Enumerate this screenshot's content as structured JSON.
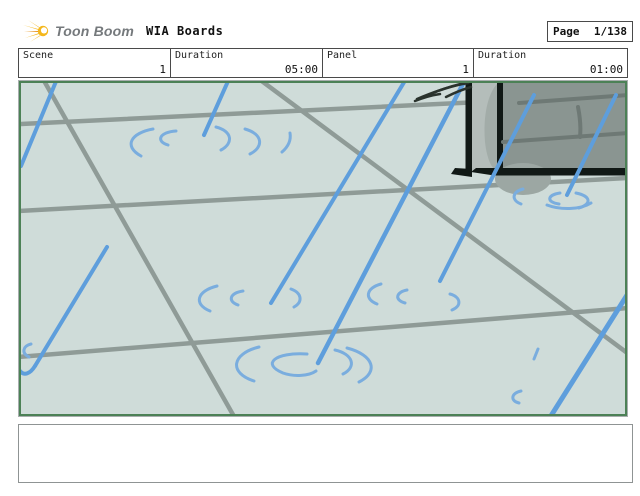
{
  "colors": {
    "page_bg": "#ffffff",
    "chrome_border": "#4a4a4a",
    "logo_yellow": "#f4b71c",
    "logo_orange": "#e89118",
    "logo_text_gray": "#75797c",
    "title_black": "#111111",
    "panel_frame_gray": "#a8aeae",
    "border_green": "#4c8156",
    "drawing_bg": "#cfdcd9",
    "tile_line": "#8f9b97",
    "rain_blue": "#5e9edc",
    "ripple_blue": "#7aadde",
    "box_front": "#8a9591",
    "box_side": "#b4bdba",
    "box_side_shade": "#a2aca8",
    "box_stripe": "#6e7975",
    "outline_black": "#111916",
    "shadow_gray": "#9ca7a3",
    "scribble_dark": "#2a332d",
    "caption_border": "#8f9494"
  },
  "header": {
    "logo_text": "Toon Boom",
    "title": "WIA Boards",
    "page_label": "Page",
    "page_number": "1/138"
  },
  "info_table": {
    "cells": [
      {
        "label": "Scene",
        "value": "1"
      },
      {
        "label": "Duration",
        "value": "05:00"
      },
      {
        "label": "Panel",
        "value": "1"
      },
      {
        "label": "Duration",
        "value": "01:00"
      }
    ]
  },
  "storyboard_panel": {
    "description": "Rain falling on tiled pavement with ripples; dark dumpster corner at top right"
  },
  "caption": {
    "text": ""
  }
}
